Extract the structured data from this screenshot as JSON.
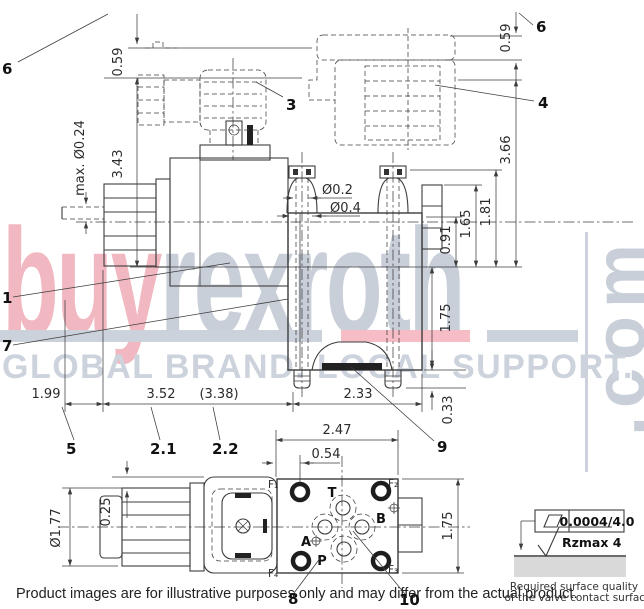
{
  "watermark": {
    "brand_left": "buy",
    "brand_right": "rexroth",
    "brand_domain": ".com",
    "tagline": "GLOBAL BRAND. LOCAL SUPPORT.",
    "colors": {
      "pink": "#f2b8c1",
      "gray_blue": "#c9cfd9",
      "bar_pink": "#f7bdc6",
      "bar_gray": "#ccd2db"
    }
  },
  "footer": {
    "disclaimer": "Product images are for illustrative purposes only and may differ from the actual product."
  },
  "surface_note": {
    "flatness_value": "0.0004/4.0",
    "roughness_value": "Rzmax 4",
    "caption_line1": "Required surface quality",
    "caption_line2": "of the valve contact surface"
  },
  "side_view": {
    "dims": {
      "clearance_left": "0.59",
      "clearance_right": "0.59",
      "solenoid_height": "3.43",
      "override_pin": "max. Ø0.24",
      "bore_small": "Ø0.2",
      "bore_large": "Ø0.4",
      "h_091": "0.91",
      "h_165": "1.65",
      "h_181": "1.81",
      "h_366": "3.66",
      "h_175": "1.75",
      "stud_033": "0.33",
      "l_199": "1.99",
      "l_352": "3.52",
      "l_338": "(3.38)",
      "l_233": "2.33"
    },
    "items": {
      "i1": "1",
      "i21": "2.1",
      "i22": "2.2",
      "i3": "3",
      "i4": "4",
      "i5": "5",
      "i6l": "6",
      "i6r": "6",
      "i7": "7",
      "i9": "9"
    }
  },
  "top_view": {
    "dims": {
      "w_247": "2.47",
      "w_054": "0.54",
      "w_025": "0.25",
      "d_177": "Ø1.77",
      "h_175": "1.75"
    },
    "ports": {
      "t": "T",
      "a": "A",
      "b": "B",
      "p": "P"
    },
    "holes": {
      "f1": "F₁",
      "f2": "F₂",
      "f3": "F₃",
      "f4": "F₄"
    },
    "items": {
      "i8": "8",
      "i10": "10"
    }
  }
}
